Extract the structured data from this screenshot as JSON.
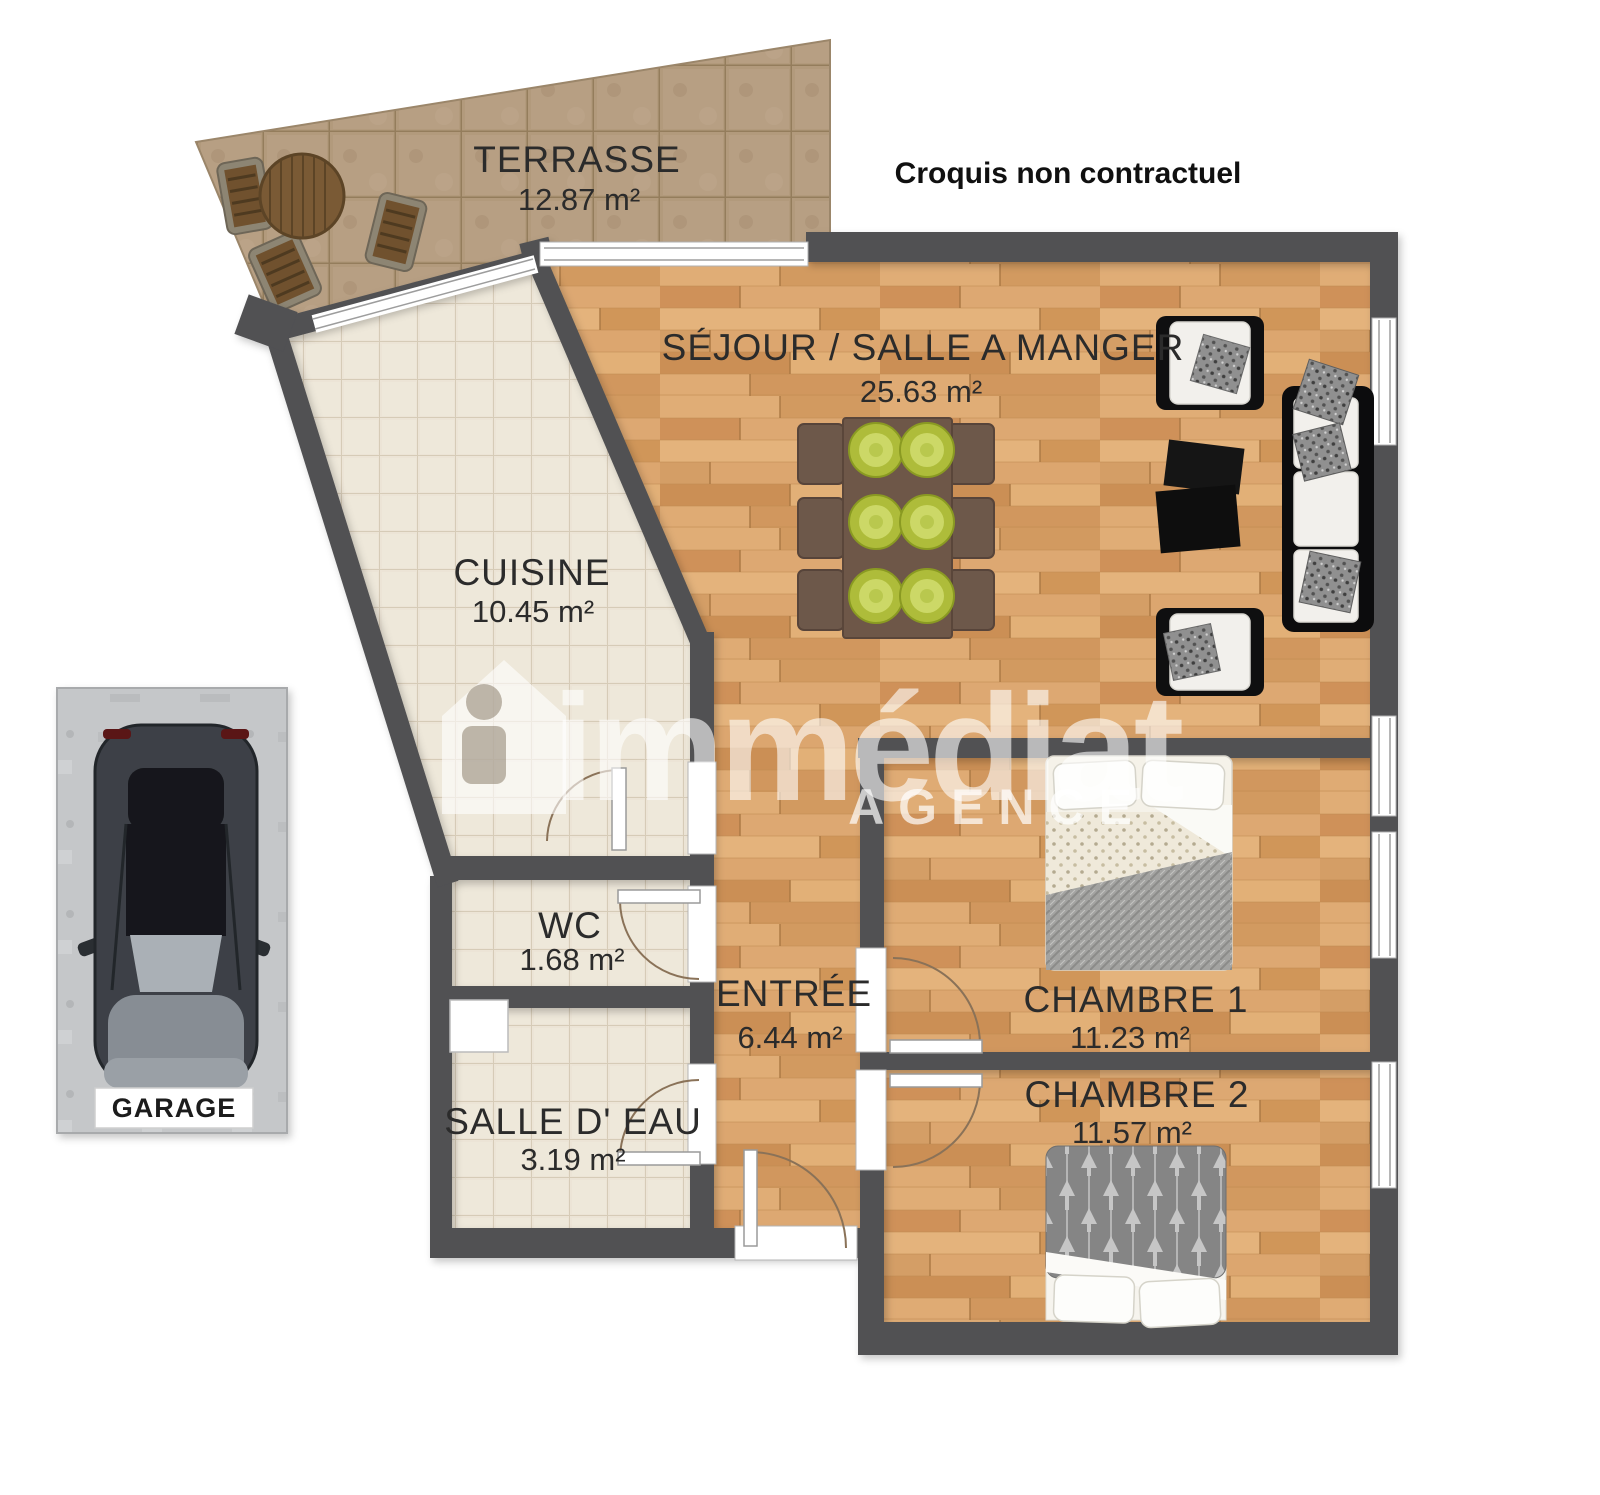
{
  "disclaimer": "Croquis non contractuel",
  "watermark": {
    "brand": "immédiat",
    "subtitle": "AGENCE"
  },
  "rooms": {
    "terrasse": {
      "name": "TERRASSE",
      "area": "12.87 m²"
    },
    "sejour": {
      "name": "SÉJOUR / SALLE A MANGER",
      "area": "25.63 m²"
    },
    "cuisine": {
      "name": "CUISINE",
      "area": "10.45 m²"
    },
    "wc": {
      "name": "WC",
      "area": "1.68 m²"
    },
    "entree": {
      "name": "ENTRÉE",
      "area": "6.44 m²"
    },
    "chambre1": {
      "name": "CHAMBRE 1",
      "area": "11.23 m²"
    },
    "chambre2": {
      "name": "CHAMBRE 2",
      "area": "11.57 m²"
    },
    "salle_eau": {
      "name": "SALLE D' EAU",
      "area": "3.19 m²"
    }
  },
  "garage": {
    "label": "GARAGE"
  },
  "colors": {
    "wall": "#515153",
    "wood_floor": "#d8a56e",
    "terrace_tile": "#b29a7c",
    "kitchen_tile": "#ece4d6",
    "plate_green": "#aebc3a"
  }
}
